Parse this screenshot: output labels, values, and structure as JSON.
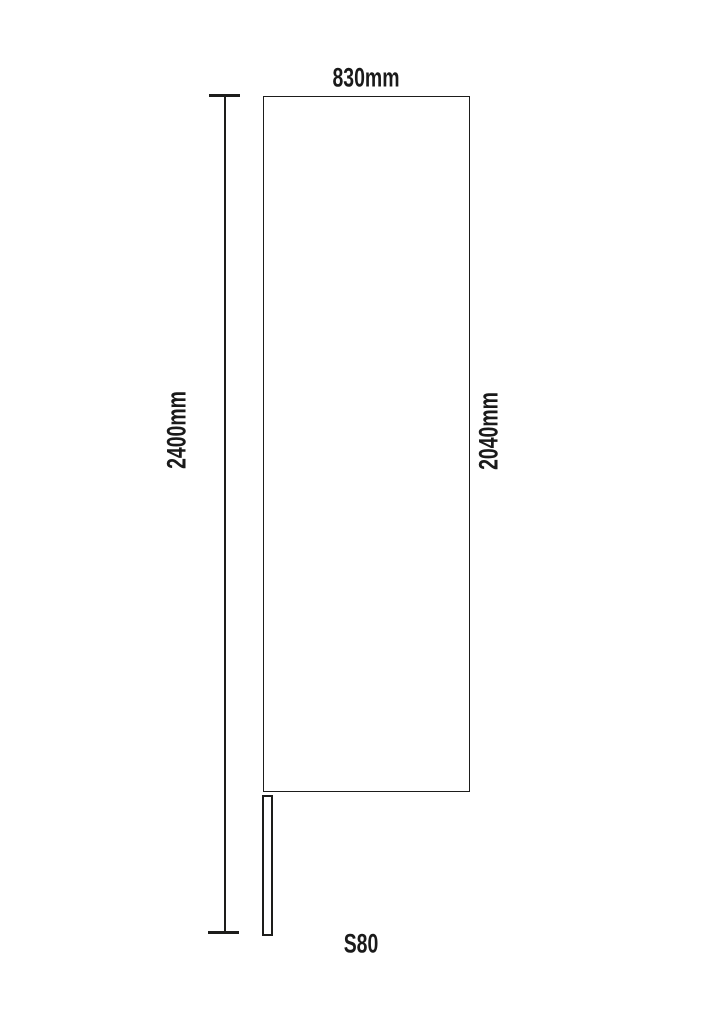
{
  "diagram": {
    "type": "dimension-drawing",
    "labels": {
      "width": "830mm",
      "overall_height": "2400mm",
      "panel_height": "2040mm",
      "model": "S80"
    },
    "dimensions_mm": {
      "width": 830,
      "overall_height": 2400,
      "panel_height": 2040
    },
    "colors": {
      "line": "#1d1d1b",
      "text": "#1a1a1a",
      "background": "#ffffff"
    }
  }
}
